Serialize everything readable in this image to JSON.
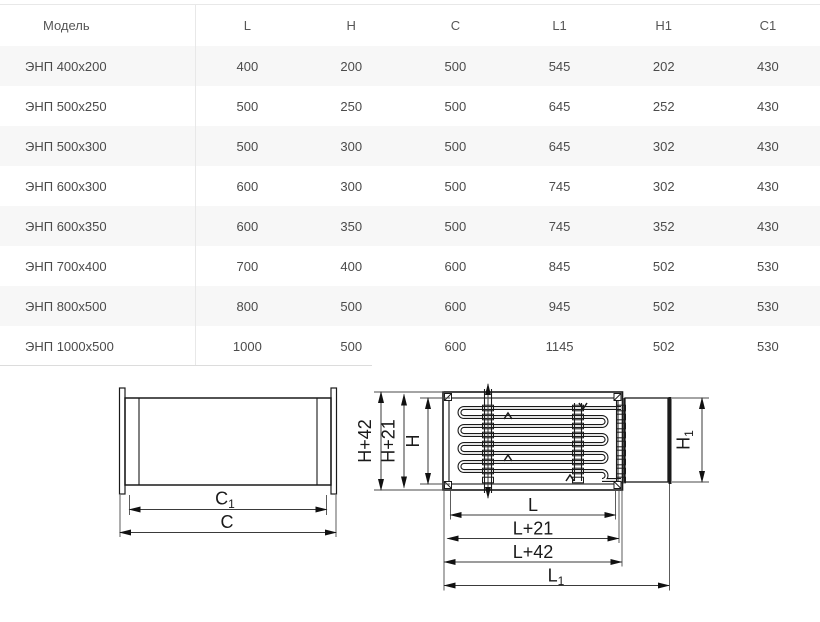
{
  "table": {
    "columns": [
      "Модель",
      "L",
      "H",
      "C",
      "L1",
      "H1",
      "C1"
    ],
    "rows": [
      {
        "model": "ЭНП 400x200",
        "l": "400",
        "h": "200",
        "c": "500",
        "l1": "545",
        "h1": "202",
        "c1": "430"
      },
      {
        "model": "ЭНП 500x250",
        "l": "500",
        "h": "250",
        "c": "500",
        "l1": "645",
        "h1": "252",
        "c1": "430"
      },
      {
        "model": "ЭНП 500x300",
        "l": "500",
        "h": "300",
        "c": "500",
        "l1": "645",
        "h1": "302",
        "c1": "430"
      },
      {
        "model": "ЭНП 600x300",
        "l": "600",
        "h": "300",
        "c": "500",
        "l1": "745",
        "h1": "302",
        "c1": "430"
      },
      {
        "model": "ЭНП 600x350",
        "l": "600",
        "h": "350",
        "c": "500",
        "l1": "745",
        "h1": "352",
        "c1": "430"
      },
      {
        "model": "ЭНП 700x400",
        "l": "700",
        "h": "400",
        "c": "600",
        "l1": "845",
        "h1": "502",
        "c1": "530"
      },
      {
        "model": "ЭНП 800x500",
        "l": "800",
        "h": "500",
        "c": "600",
        "l1": "945",
        "h1": "502",
        "c1": "530"
      },
      {
        "model": "ЭНП 1000x500",
        "l": "1000",
        "h": "500",
        "c": "600",
        "l1": "1145",
        "h1": "502",
        "c1": "530"
      }
    ]
  },
  "diagrams": {
    "side_view": {
      "c": "C",
      "c1": {
        "base": "C",
        "sub": "1"
      }
    },
    "plan_view": {
      "h42": "H+42",
      "h21": "H+21",
      "h": "H",
      "h1": {
        "base": "H",
        "sub": "1"
      },
      "l": "L",
      "l21": "L+21",
      "l42": "L+42",
      "l1": {
        "base": "L",
        "sub": "1"
      }
    }
  },
  "colors": {
    "table_border": "#e8e8e8",
    "row_alt": "#f7f7f7",
    "table_text": "#4b4b4b",
    "drawing_line": "#1a1a1a"
  }
}
